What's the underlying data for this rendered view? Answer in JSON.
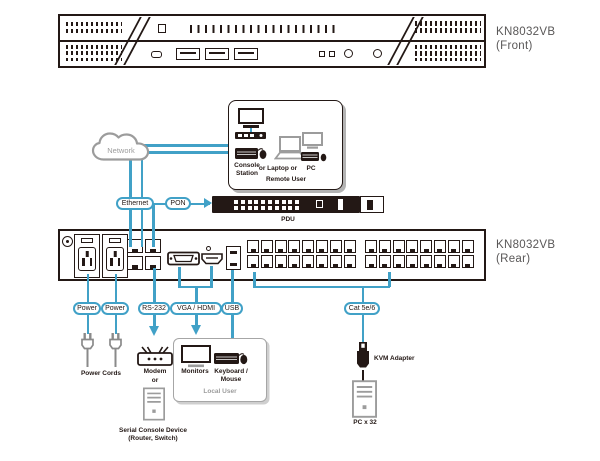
{
  "colors": {
    "accent_blue": "#41a1c7",
    "line_ink": "#231815",
    "icon_gray": "#9c9c9c",
    "label_gray": "#595757"
  },
  "front": {
    "model": "KN8032VB",
    "view": "(Front)"
  },
  "rear": {
    "model": "KN8032VB",
    "view": "(Rear)"
  },
  "network": {
    "cloud": "Network",
    "ethernet": "Ethernet",
    "pon": "PON",
    "pdu": "PDU"
  },
  "remote": {
    "console_station": "Console Station",
    "or_laptop_or": "or Laptop or",
    "pc": "PC",
    "remote_user": "Remote User"
  },
  "cables": {
    "power_left": "Power",
    "power_right": "Power",
    "rs232": "RS-232",
    "vga_hdmi": "VGA / HDMI",
    "usb": "USB",
    "cat": "Cat 5e/6"
  },
  "devices": {
    "power_cords": "Power Cords",
    "modem": "Modem",
    "or": "or",
    "serial_console_line1": "Serial Console Device",
    "serial_console_line2": "(Router, Switch)",
    "monitors": "Monitors",
    "keyboard_mouse": "Keyboard / Mouse",
    "local_user": "Local User",
    "kvm_adapter": "KVM Adapter",
    "pc_count": "PC x 32"
  },
  "icons": {
    "network-cloud-icon": "cloud shape",
    "console-monitor-icon": "monitor",
    "console-station-icon": "console station bar",
    "keyboard-mouse-icon": "keyboard with mouse",
    "laptop-icon": "laptop",
    "pc-monitor-icon": "monitor",
    "power-plug-icon": "power plug",
    "modem-icon": "modem with antennas",
    "server-tower-icon": "tower computer",
    "monitor-icon": "monitor",
    "kvm-adapter-icon": "kvm adapter dongle",
    "pdu-icon": "rack pdu strip"
  }
}
